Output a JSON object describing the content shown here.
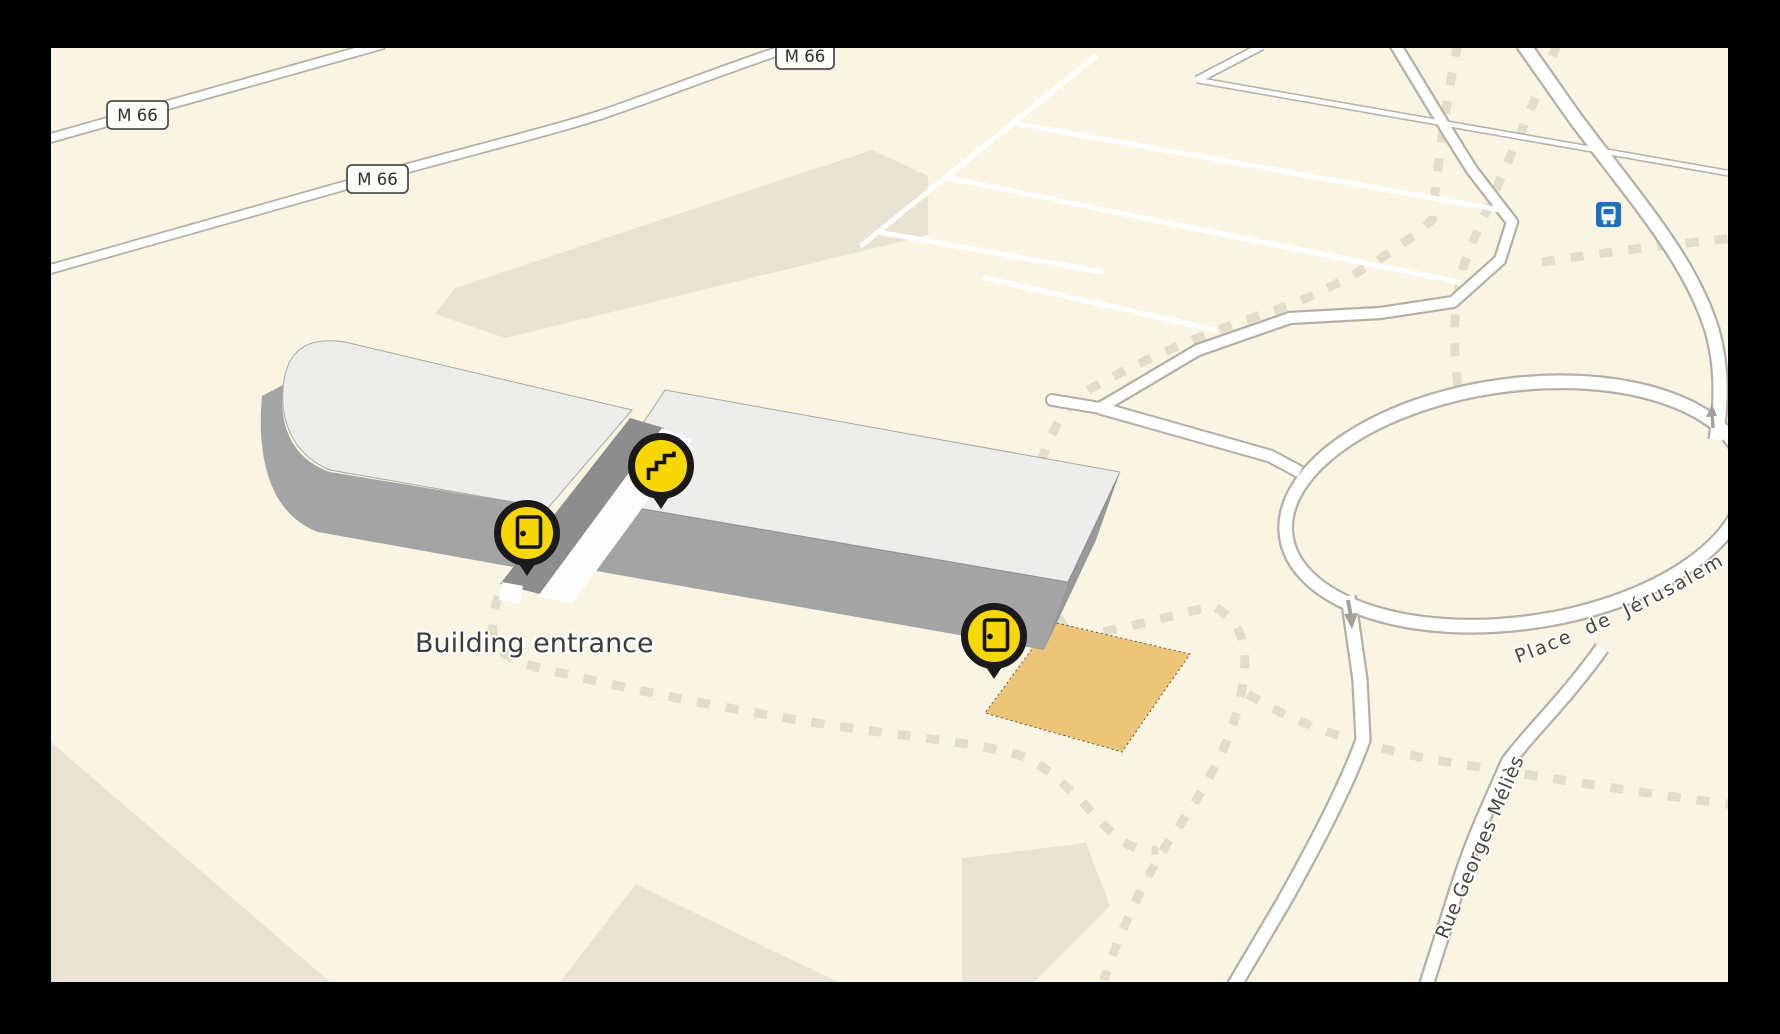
{
  "map": {
    "labels": {
      "building_entrance": "Building entrance",
      "place": "Place de Jérusalem",
      "street": "Rue Georges Méliès"
    },
    "shields": [
      {
        "label": "M 66"
      },
      {
        "label": "M 66"
      },
      {
        "label": "M 66"
      }
    ],
    "markers": [
      {
        "kind": "entrance-door",
        "icon": "door-icon"
      },
      {
        "kind": "stairs",
        "icon": "stairs-icon"
      },
      {
        "kind": "entrance-door",
        "icon": "door-icon"
      }
    ],
    "transit_stops": [
      {
        "kind": "bus-stop",
        "icon": "bus-icon"
      }
    ],
    "oneway_arrows": 2
  },
  "theme": {
    "land": "#faf4e2",
    "landuse": "#e9e3d3",
    "dash": "#e3ddca",
    "casing": "#b5b0a6",
    "road-fill": "#ffffff",
    "roof": "#ededeb",
    "wall": "#a4a4a4",
    "wall-dark": "#8d8d8d",
    "marker-yellow": "#f7d700",
    "marker-black": "#1a1a1a",
    "bus-blue": "#1d70bf",
    "highlight-orange": "#ecc578",
    "label": "#4a453d"
  }
}
